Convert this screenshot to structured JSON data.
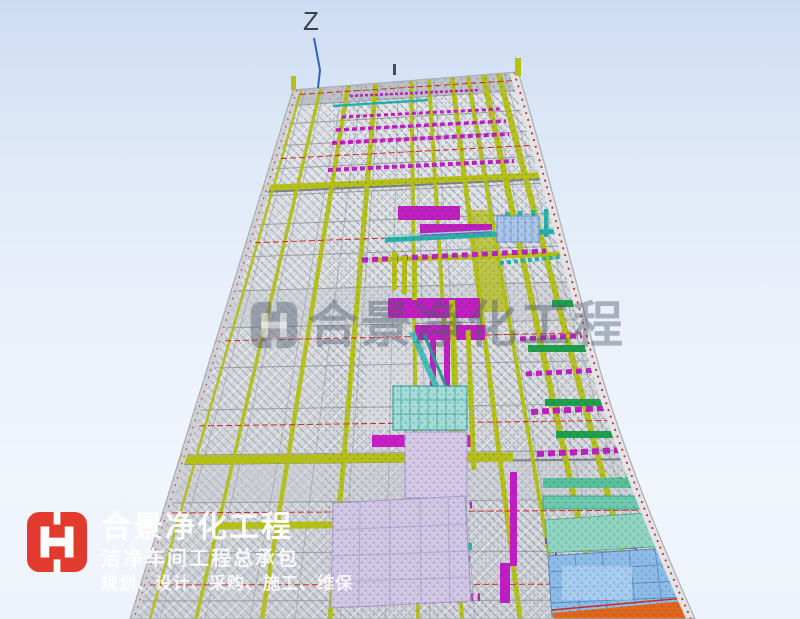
{
  "viewport": {
    "width": 800,
    "height": 619
  },
  "axis": {
    "label": "Z"
  },
  "watermark": {
    "text": "合景净化工程"
  },
  "logo": {
    "title": "合景净化工程",
    "subtitle": "洁净车间工程总承包",
    "services": "规划、设计、采购、施工、维保"
  },
  "colors": {
    "sky_top": "#cedcf3",
    "sky_bottom": "#f1f5fc",
    "structure_gray": "#d6d9dd",
    "grid_gray": "#8f959d",
    "beam_yellow": "#b4bf17",
    "duct_magenta": "#bf1fbf",
    "duct_cyan": "#2ab0ac",
    "bar_green": "#1f9e4e",
    "line_red": "#cf2a20",
    "panel_blue": "#8cbce8",
    "panel_lavender": "#cfc6e4",
    "panel_mint": "#8fd4c0",
    "band_orange": "#e0661c",
    "axis_blue": "#2b62c8",
    "logo_red": "#e23b2e"
  }
}
